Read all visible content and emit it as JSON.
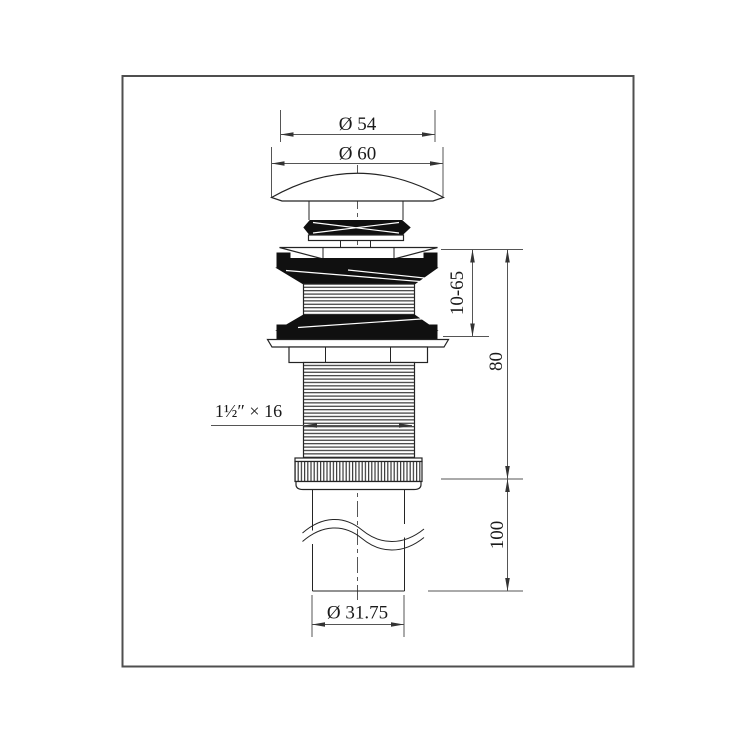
{
  "drawing": {
    "title": "pop-up basin drain technical drawing",
    "labels": {
      "dia_cap_top": "Ø 54",
      "dia_cap": "Ø 60",
      "clamp_range": "10-65",
      "body_length": "80",
      "tail_length": "100",
      "thread_spec": "1½″ × 16",
      "dia_tailpipe": "Ø 31.75"
    },
    "colors": {
      "background": "#ffffff",
      "border": "#4f4f4f",
      "part_line": "#242424",
      "dark_fill": "#101010",
      "dimension_line": "#555555",
      "text": "#1a1a1a"
    }
  }
}
